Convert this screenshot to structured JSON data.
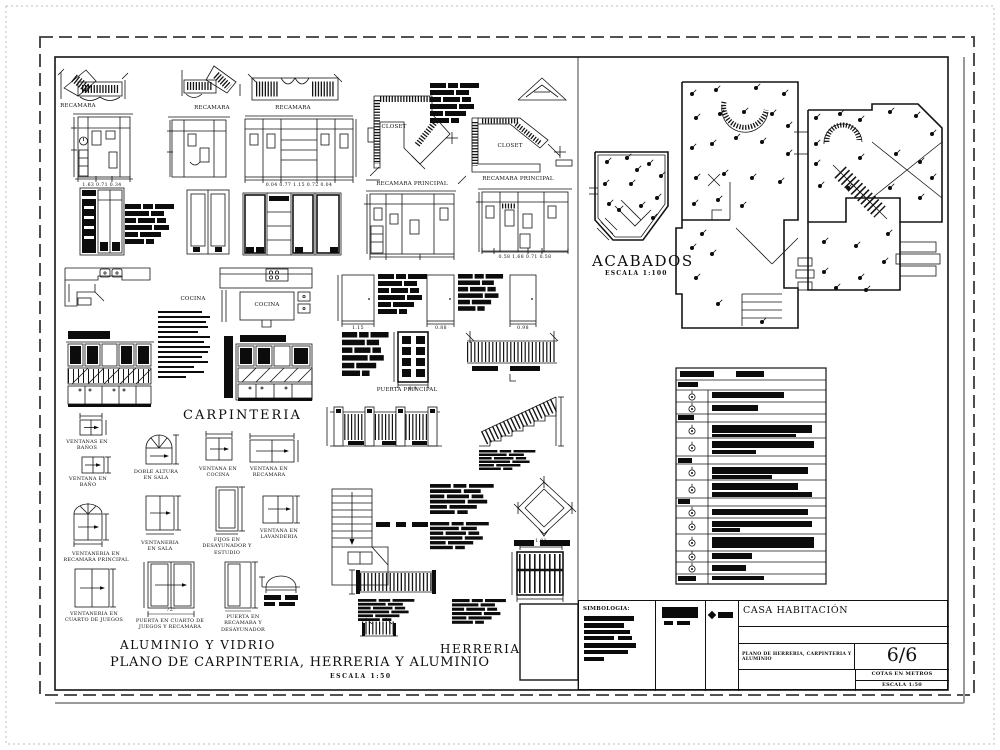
{
  "plan_labels": {
    "recamara_1": "RECAMARA",
    "recamara_2": "RECAMARA",
    "recamara_3": "RECAMARA",
    "closet_1": "CLOSET",
    "closet_2": "CLOSET",
    "recamara_principal_1": "RECAMARA PRINCIPAL",
    "recamara_principal_2": "RECAMARA PRINCIPAL",
    "cocina_1": "COCINA",
    "cocina_2": "COCINA",
    "puerta_principal": "PUERTA PRINCIPAL"
  },
  "window_labels": {
    "ventanas_banos": "VENTANAS EN BAÑOS",
    "ventana_bano": "VENTANA EN BAÑO",
    "doble_altura_sala": "DOBLE ALTURA EN SALA",
    "ventana_cocina": "VENTANA EN COCINA",
    "ventana_recamara": "VENTANA EN RECAMARA",
    "ventaneria_recamara_principal": "VENTANERIA EN RECAMARA PRINCIPAL",
    "ventaneria_sala": "VENTANERIA EN SALA",
    "fijos_desayunador": "FIJOS EN DESAYUNADOR Y ESTUDIO",
    "ventana_lavanderia": "VENTANA EN LAVANDERIA",
    "ventaneria_cuarto_juegos": "VENTANERIA EN CUARTO DE JUEGOS",
    "puerta_cuarto_juegos": "PUERTA EN CUARTO DE JUEGOS Y RECAMARA",
    "puerta_recamara_desayunador": "PUERTA EN RECAMARA Y DESAYUNADOR"
  },
  "dimensions": {
    "elev1": "1.63  0.71  0.34",
    "elev3": "0.04  0.77  1.15  0.72  0.04",
    "elev_rp": "0.58  1.68  0.71  0.58",
    "door1": "1.15",
    "door2": "0.88",
    "door3": "0.98",
    "puerta_principal": "0.9",
    "reja": "1.01",
    "puerta_juegos": "72\""
  },
  "acabados": {
    "title": "ACABADOS",
    "escala": "ESCALA 1:100"
  },
  "footer": {
    "carpinteria": "CARPINTERIA",
    "aluminio": "ALUMINIO Y VIDRIO",
    "herreria": "HERRERIA",
    "main_title": "PLANO DE CARPINTERIA, HERRERIA Y ALUMINIO",
    "main_escala": "ESCALA 1:50"
  },
  "titleblock": {
    "simbologia": "SIMBOLOGIA:",
    "project": "CASA HABITACIÓN",
    "sheet_name": "PLANO DE HERRERIA, CARPINTERIA Y ALUMINIO",
    "page": "6/6",
    "units": "COTAS EN METROS",
    "escala": "ESCALA 1:50"
  }
}
